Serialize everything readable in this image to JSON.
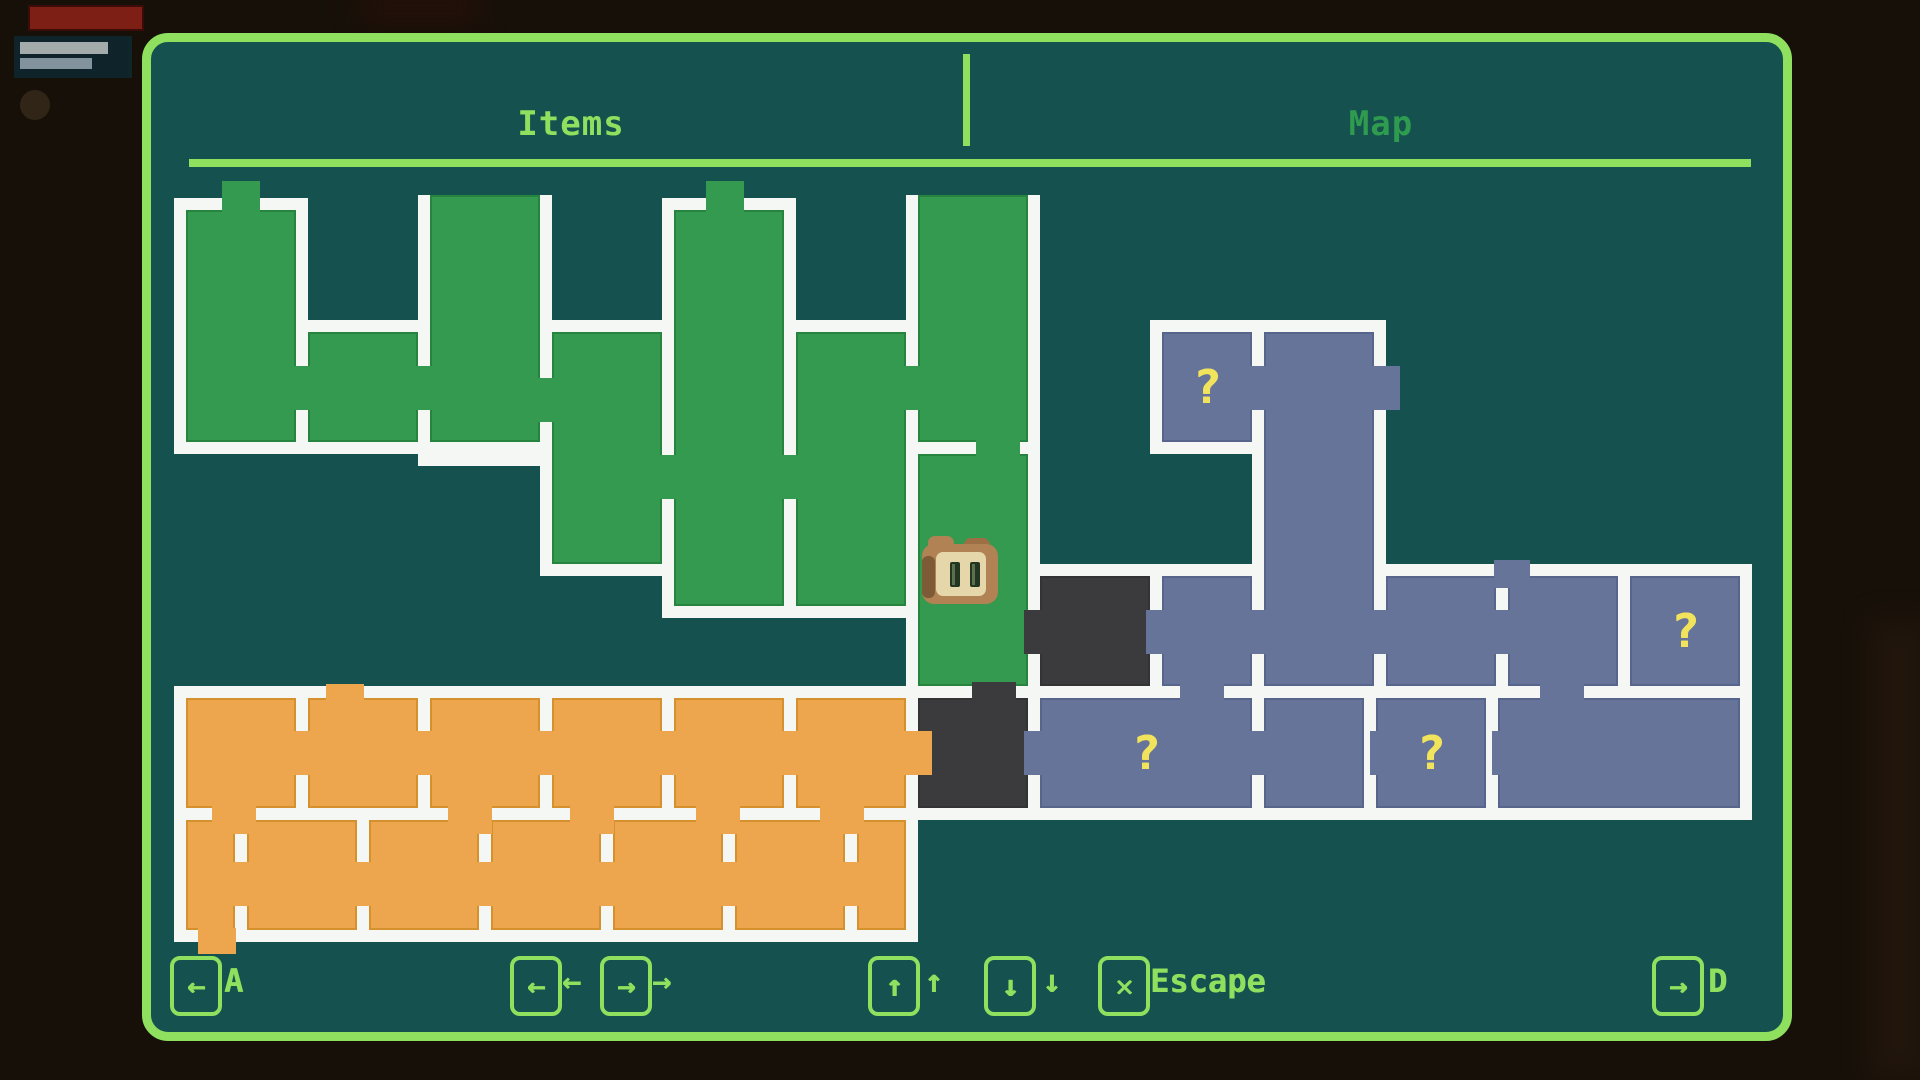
{
  "tabs": {
    "left": "Items",
    "right": "Map"
  },
  "colors": {
    "accent": "#8ee05e",
    "tab_inactive": "#2f9b4e",
    "wall": "#f5f7f5",
    "room_green": "#339a4f",
    "room_orange": "#eda64e",
    "room_slate": "#66749a",
    "room_dark": "#3b3b3d",
    "panel_bg": "#14514f",
    "marker_yellow": "#f2e35c",
    "outside_bg": "#171009"
  },
  "hints": [
    {
      "name": "key-a",
      "glyph": "←",
      "label": "A",
      "bx": 170,
      "lx": 224
    },
    {
      "name": "key-left",
      "glyph": "←",
      "label": "←",
      "bx": 510,
      "lx": 562
    },
    {
      "name": "key-right",
      "glyph": "→",
      "label": "→",
      "bx": 600,
      "lx": 652
    },
    {
      "name": "key-up",
      "glyph": "↑",
      "label": "↑",
      "bx": 868,
      "lx": 924
    },
    {
      "name": "key-down",
      "glyph": "↓",
      "label": "↓",
      "bx": 984,
      "lx": 1042
    },
    {
      "name": "key-escape",
      "glyph": "✕",
      "label": "Escape",
      "bx": 1098,
      "lx": 1150
    },
    {
      "name": "key-d",
      "glyph": "→",
      "label": "D",
      "bx": 1652,
      "lx": 1708
    }
  ],
  "map": {
    "player": {
      "x": 922,
      "y": 536
    },
    "rooms": [
      {
        "x": 186,
        "y": 210,
        "w": 110,
        "h": 232,
        "c": "green"
      },
      {
        "x": 308,
        "y": 332,
        "w": 110,
        "h": 110,
        "c": "green"
      },
      {
        "x": 430,
        "y": 195,
        "w": 110,
        "h": 247,
        "c": "green",
        "open_top": true
      },
      {
        "x": 552,
        "y": 332,
        "w": 110,
        "h": 232,
        "c": "green"
      },
      {
        "x": 674,
        "y": 210,
        "w": 110,
        "h": 396,
        "c": "green"
      },
      {
        "x": 796,
        "y": 332,
        "w": 110,
        "h": 274,
        "c": "green"
      },
      {
        "x": 918,
        "y": 195,
        "w": 110,
        "h": 247,
        "c": "green",
        "open_top": true
      },
      {
        "x": 918,
        "y": 454,
        "w": 110,
        "h": 232,
        "c": "green"
      },
      {
        "x": 1040,
        "y": 576,
        "w": 110,
        "h": 110,
        "c": "dark"
      },
      {
        "x": 918,
        "y": 698,
        "w": 110,
        "h": 110,
        "c": "dark"
      },
      {
        "x": 186,
        "y": 698,
        "w": 110,
        "h": 110,
        "c": "orange"
      },
      {
        "x": 308,
        "y": 698,
        "w": 110,
        "h": 110,
        "c": "orange"
      },
      {
        "x": 430,
        "y": 698,
        "w": 110,
        "h": 110,
        "c": "orange"
      },
      {
        "x": 552,
        "y": 698,
        "w": 110,
        "h": 110,
        "c": "orange"
      },
      {
        "x": 674,
        "y": 698,
        "w": 110,
        "h": 110,
        "c": "orange"
      },
      {
        "x": 796,
        "y": 698,
        "w": 110,
        "h": 110,
        "c": "orange"
      },
      {
        "x": 186,
        "y": 820,
        "w": 49,
        "h": 110,
        "c": "orange"
      },
      {
        "x": 247,
        "y": 820,
        "w": 110,
        "h": 110,
        "c": "orange"
      },
      {
        "x": 369,
        "y": 820,
        "w": 110,
        "h": 110,
        "c": "orange"
      },
      {
        "x": 491,
        "y": 820,
        "w": 110,
        "h": 110,
        "c": "orange"
      },
      {
        "x": 613,
        "y": 820,
        "w": 110,
        "h": 110,
        "c": "orange"
      },
      {
        "x": 735,
        "y": 820,
        "w": 110,
        "h": 110,
        "c": "orange"
      },
      {
        "x": 857,
        "y": 820,
        "w": 49,
        "h": 110,
        "c": "orange"
      },
      {
        "x": 1162,
        "y": 332,
        "w": 90,
        "h": 110,
        "c": "slate",
        "mark": true
      },
      {
        "x": 1264,
        "y": 332,
        "w": 110,
        "h": 354,
        "c": "slate"
      },
      {
        "x": 1162,
        "y": 576,
        "w": 90,
        "h": 110,
        "c": "slate"
      },
      {
        "x": 1386,
        "y": 576,
        "w": 110,
        "h": 110,
        "c": "slate"
      },
      {
        "x": 1508,
        "y": 576,
        "w": 110,
        "h": 110,
        "c": "slate"
      },
      {
        "x": 1630,
        "y": 576,
        "w": 110,
        "h": 110,
        "c": "slate",
        "mark": true
      },
      {
        "x": 1040,
        "y": 698,
        "w": 212,
        "h": 110,
        "c": "slate",
        "mark": true
      },
      {
        "x": 1264,
        "y": 698,
        "w": 100,
        "h": 110,
        "c": "slate"
      },
      {
        "x": 1376,
        "y": 698,
        "w": 110,
        "h": 110,
        "c": "slate",
        "mark": true
      },
      {
        "x": 1498,
        "y": 698,
        "w": 242,
        "h": 110,
        "c": "slate"
      }
    ],
    "doors": [
      {
        "x": 222,
        "y": 181,
        "w": 38,
        "h": 33,
        "c": "green"
      },
      {
        "x": 706,
        "y": 181,
        "w": 38,
        "h": 33,
        "c": "green"
      },
      {
        "x": 292,
        "y": 366,
        "w": 30,
        "h": 44,
        "c": "green"
      },
      {
        "x": 414,
        "y": 366,
        "w": 30,
        "h": 44,
        "c": "green"
      },
      {
        "x": 536,
        "y": 378,
        "w": 30,
        "h": 44,
        "c": "green"
      },
      {
        "x": 658,
        "y": 455,
        "w": 30,
        "h": 44,
        "c": "green"
      },
      {
        "x": 780,
        "y": 455,
        "w": 30,
        "h": 44,
        "c": "green"
      },
      {
        "x": 902,
        "y": 366,
        "w": 30,
        "h": 44,
        "c": "green"
      },
      {
        "x": 976,
        "y": 438,
        "w": 44,
        "h": 30,
        "c": "green"
      },
      {
        "x": 1024,
        "y": 610,
        "w": 30,
        "h": 44,
        "c": "dark"
      },
      {
        "x": 972,
        "y": 682,
        "w": 44,
        "h": 30,
        "c": "dark"
      },
      {
        "x": 1146,
        "y": 610,
        "w": 30,
        "h": 44,
        "c": "slate"
      },
      {
        "x": 1248,
        "y": 610,
        "w": 30,
        "h": 44,
        "c": "slate"
      },
      {
        "x": 1248,
        "y": 366,
        "w": 30,
        "h": 44,
        "c": "slate"
      },
      {
        "x": 1370,
        "y": 366,
        "w": 30,
        "h": 44,
        "c": "slate"
      },
      {
        "x": 1370,
        "y": 610,
        "w": 30,
        "h": 44,
        "c": "slate"
      },
      {
        "x": 1492,
        "y": 610,
        "w": 30,
        "h": 44,
        "c": "slate"
      },
      {
        "x": 1494,
        "y": 560,
        "w": 36,
        "h": 28,
        "c": "slate"
      },
      {
        "x": 1024,
        "y": 731,
        "w": 30,
        "h": 44,
        "c": "slate"
      },
      {
        "x": 1248,
        "y": 731,
        "w": 30,
        "h": 44,
        "c": "slate"
      },
      {
        "x": 1370,
        "y": 731,
        "w": 30,
        "h": 44,
        "c": "slate"
      },
      {
        "x": 1492,
        "y": 731,
        "w": 30,
        "h": 44,
        "c": "slate"
      },
      {
        "x": 1180,
        "y": 682,
        "w": 44,
        "h": 30,
        "c": "slate"
      },
      {
        "x": 1540,
        "y": 682,
        "w": 44,
        "h": 30,
        "c": "slate"
      },
      {
        "x": 292,
        "y": 731,
        "w": 30,
        "h": 44,
        "c": "orange"
      },
      {
        "x": 414,
        "y": 731,
        "w": 30,
        "h": 44,
        "c": "orange"
      },
      {
        "x": 536,
        "y": 731,
        "w": 30,
        "h": 44,
        "c": "orange"
      },
      {
        "x": 658,
        "y": 731,
        "w": 30,
        "h": 44,
        "c": "orange"
      },
      {
        "x": 780,
        "y": 731,
        "w": 30,
        "h": 44,
        "c": "orange"
      },
      {
        "x": 902,
        "y": 731,
        "w": 30,
        "h": 44,
        "c": "orange"
      },
      {
        "x": 231,
        "y": 862,
        "w": 30,
        "h": 44,
        "c": "orange"
      },
      {
        "x": 353,
        "y": 862,
        "w": 30,
        "h": 44,
        "c": "orange"
      },
      {
        "x": 475,
        "y": 862,
        "w": 30,
        "h": 44,
        "c": "orange"
      },
      {
        "x": 597,
        "y": 862,
        "w": 30,
        "h": 44,
        "c": "orange"
      },
      {
        "x": 719,
        "y": 862,
        "w": 30,
        "h": 44,
        "c": "orange"
      },
      {
        "x": 841,
        "y": 862,
        "w": 30,
        "h": 44,
        "c": "orange"
      },
      {
        "x": 212,
        "y": 804,
        "w": 44,
        "h": 30,
        "c": "orange"
      },
      {
        "x": 448,
        "y": 804,
        "w": 44,
        "h": 30,
        "c": "orange"
      },
      {
        "x": 570,
        "y": 804,
        "w": 44,
        "h": 30,
        "c": "orange"
      },
      {
        "x": 696,
        "y": 804,
        "w": 44,
        "h": 30,
        "c": "orange"
      },
      {
        "x": 820,
        "y": 804,
        "w": 44,
        "h": 30,
        "c": "orange"
      },
      {
        "x": 326,
        "y": 684,
        "w": 38,
        "h": 28,
        "c": "orange"
      },
      {
        "x": 198,
        "y": 928,
        "w": 38,
        "h": 26,
        "c": "orange"
      }
    ],
    "marker_glyph": "?"
  }
}
